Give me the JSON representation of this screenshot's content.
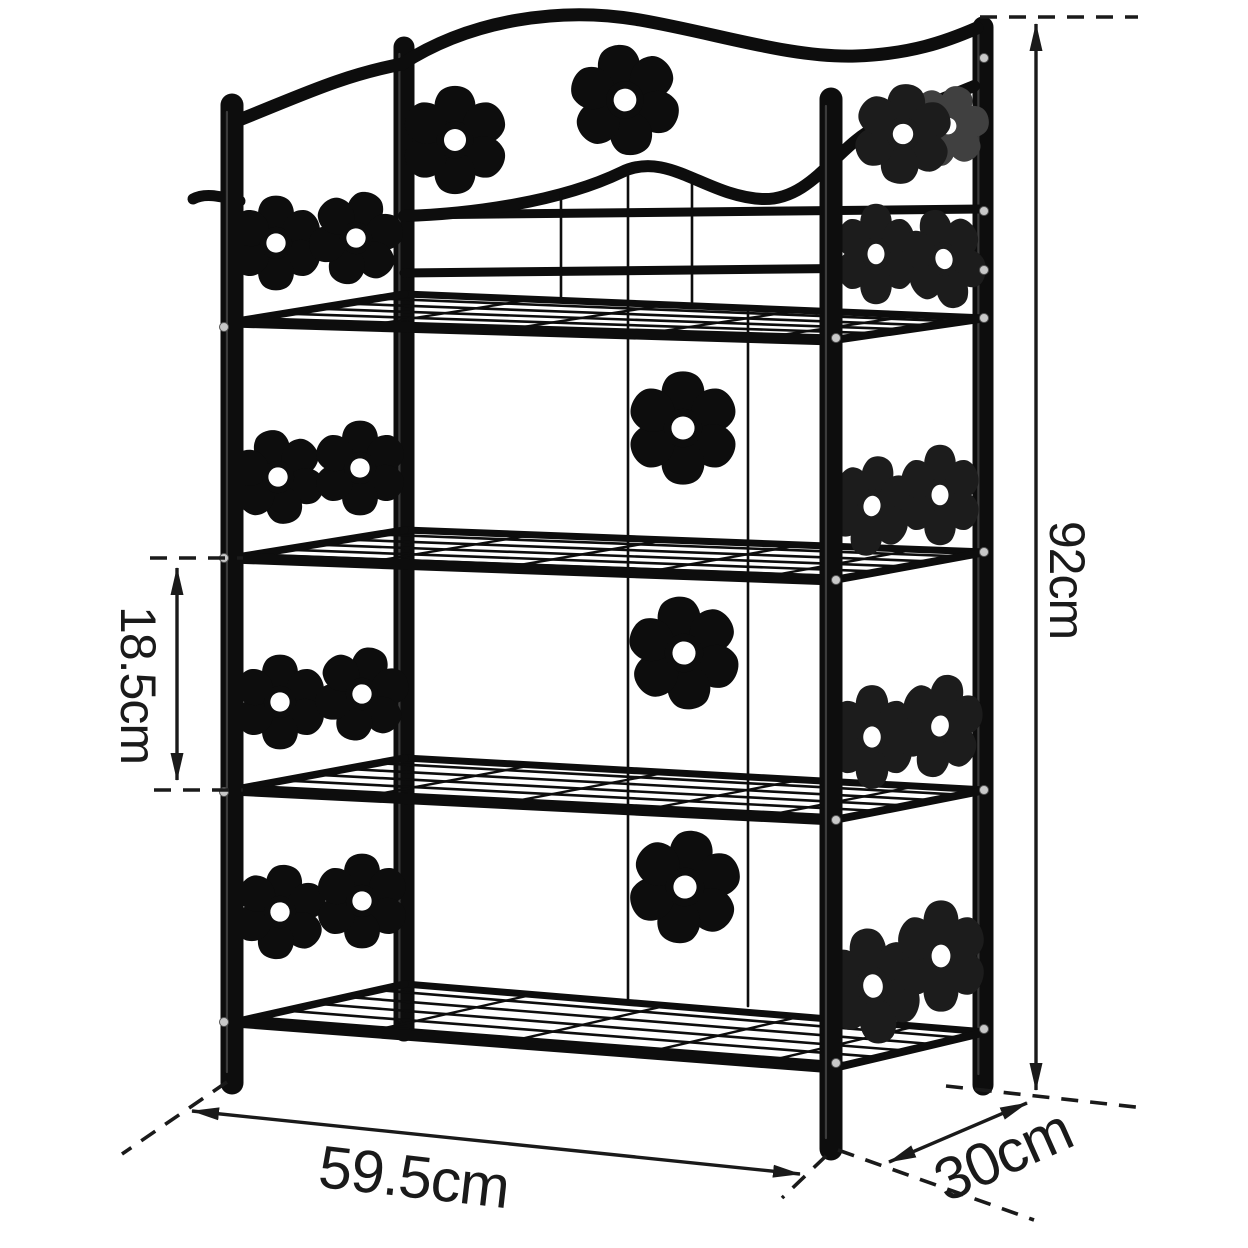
{
  "diagram": {
    "type": "product-dimension-diagram",
    "subject": "4-tier metal storage rack with flower cutout decoration"
  },
  "dimensions": {
    "height": {
      "label": "92cm",
      "value": 92,
      "unit": "cm"
    },
    "shelf_spacing": {
      "label": "18.5cm",
      "value": 18.5,
      "unit": "cm"
    },
    "width": {
      "label": "59.5cm",
      "value": 59.5,
      "unit": "cm"
    },
    "depth": {
      "label": "30cm",
      "value": 30,
      "unit": "cm"
    }
  },
  "icons": {
    "flower_cutout": {
      "name": "flower-cutout-icon",
      "petals": 6,
      "count": 22
    },
    "dimension_arrow": {
      "name": "dimension-arrow-icon",
      "style": "double-headed"
    }
  },
  "colors": {
    "background": "#ffffff",
    "metal": "#0d0d0d",
    "metal_right_panels": "#1c1c1c",
    "bolt": "#c8c8c8",
    "annotation_ink": "#1a1a1a"
  }
}
